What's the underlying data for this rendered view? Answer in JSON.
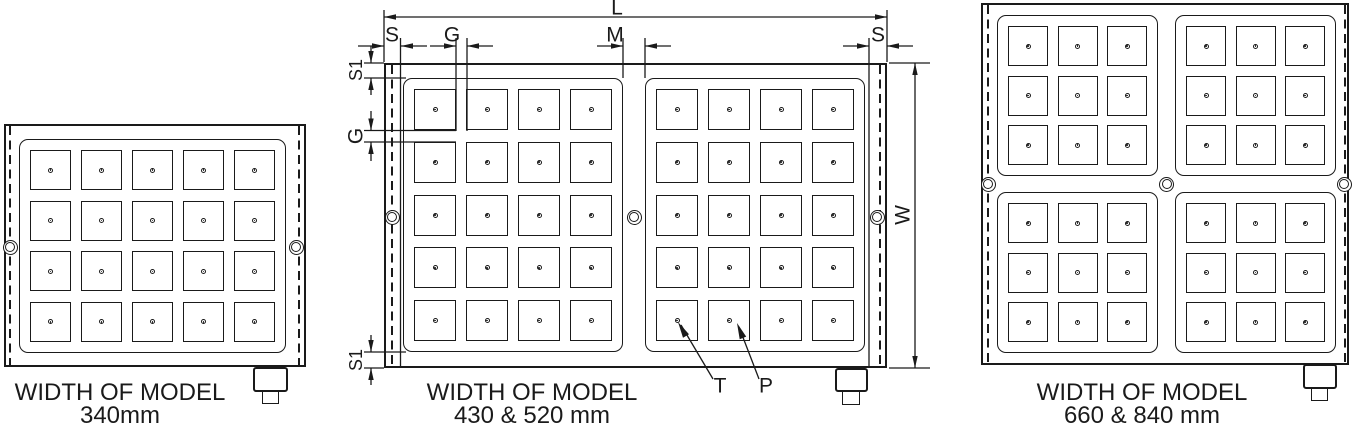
{
  "ink_color": "#1a1a1a",
  "models": [
    {
      "id": "model-340",
      "caption_line1": "WIDTH OF MODEL",
      "caption_line2": "340mm",
      "pole_blocks": [
        {
          "cols": 5,
          "rows": 4
        }
      ]
    },
    {
      "id": "model-430-520",
      "caption_line1": "WIDTH OF MODEL",
      "caption_line2": "430 & 520 mm",
      "pole_blocks": [
        {
          "cols": 4,
          "rows": 5
        },
        {
          "cols": 4,
          "rows": 5
        }
      ]
    },
    {
      "id": "model-660-840",
      "caption_line1": "WIDTH OF MODEL",
      "caption_line2": "660 & 840 mm",
      "pole_blocks": [
        {
          "cols": 3,
          "rows": 3
        },
        {
          "cols": 3,
          "rows": 3
        },
        {
          "cols": 3,
          "rows": 3
        },
        {
          "cols": 3,
          "rows": 3
        }
      ]
    }
  ],
  "dimension_labels": {
    "length": "L",
    "side_left": "S",
    "pole_gap_horizontal": "G",
    "center_divider": "M",
    "side_right": "S",
    "edge_margin_top": "S1",
    "pole_gap_vertical": "G",
    "edge_margin_bottom": "S1",
    "overall_width": "W",
    "pole_pointer_t": "T",
    "pole_pointer_p": "P"
  }
}
